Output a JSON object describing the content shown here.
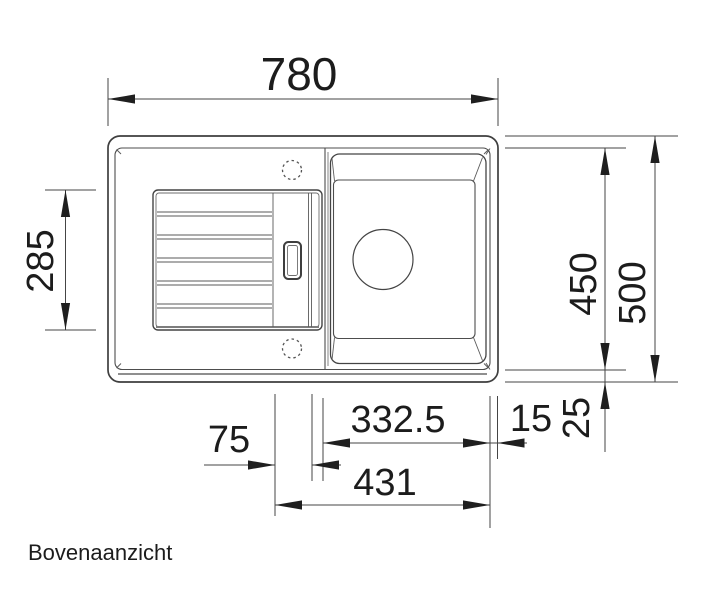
{
  "title": "Bovenaanzicht",
  "dimensions": {
    "overall_width": "780",
    "overall_depth": "500",
    "inner_depth": "450",
    "drainboard_depth": "285",
    "bowl_zone_width": "431",
    "bowl_inner_width": "332.5",
    "right_rim": "15",
    "bottom_rim": "25",
    "center_strip_width": "75"
  },
  "colors": {
    "background": "#ffffff",
    "line": "#4a4a4a",
    "dimension_text": "#1c1c1c"
  }
}
